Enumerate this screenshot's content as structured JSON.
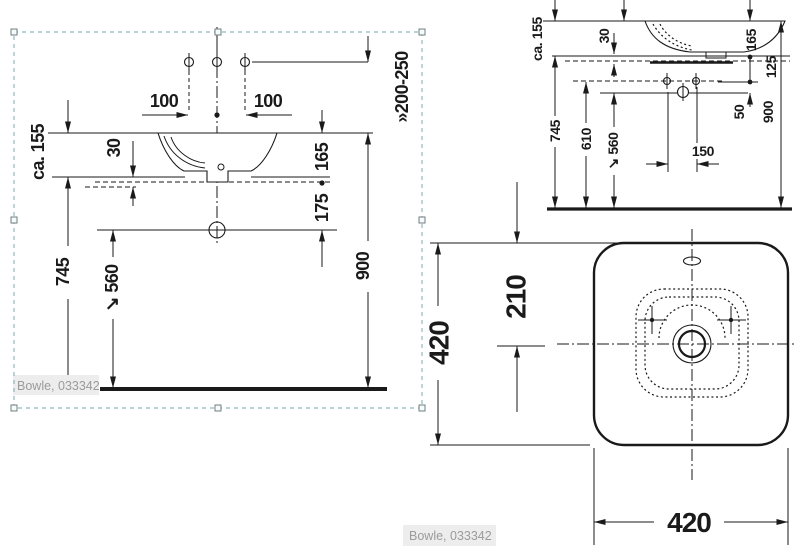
{
  "front_view": {
    "product_label": "Bowle, 033342",
    "dims": {
      "d100_left": "100",
      "d100_right": "100",
      "d200_250": "»200-250",
      "dca155": "ca. 155",
      "d30": "30",
      "d165": "165",
      "d175": "175",
      "d745": "745",
      "d560": "↘ 560",
      "d900": "900"
    }
  },
  "side_view": {
    "dims": {
      "dca155": "ca. 155",
      "d30": "30",
      "d165": "165",
      "d125": "125",
      "d50": "50",
      "d745": "745",
      "d610": "610",
      "d560": "↘ 560",
      "d150": "150",
      "d900": "900"
    }
  },
  "plan_view": {
    "product_label": "Bowle, 033342",
    "dims": {
      "d420_left": "420",
      "d210": "210",
      "d420_bottom": "420"
    }
  },
  "colors": {
    "line": "#1a1a1a",
    "selection": "#8fb7ba",
    "label_text": "#9b9b9b",
    "label_bg": "#ededed",
    "paper": "#ffffff"
  }
}
